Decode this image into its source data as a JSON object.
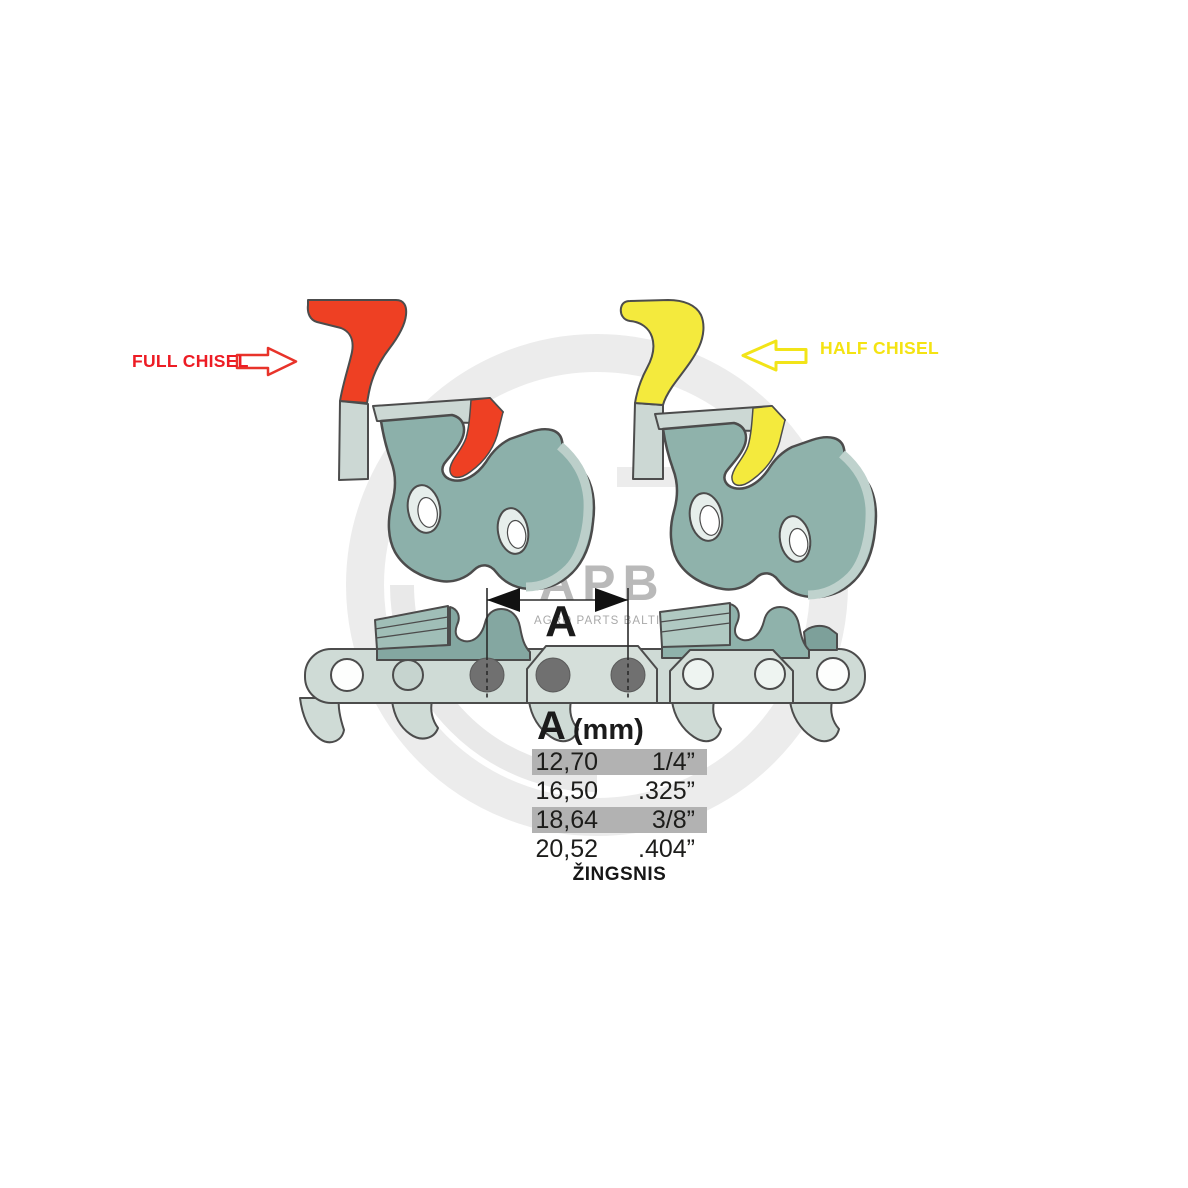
{
  "labels": {
    "full_chisel": "FULL CHISEL",
    "half_chisel": "HALF CHISEL",
    "dimension": "A",
    "pitch_caption": "ŽINGSNIS"
  },
  "watermark": {
    "logo": "APB",
    "tagline": "AGRO PARTS BALTIJA"
  },
  "pitch_table": {
    "header": {
      "symbol": "A",
      "unit": "(mm)"
    },
    "rows": [
      {
        "mm": "12,70",
        "inches": "1/4”",
        "highlighted": true
      },
      {
        "mm": "16,50",
        "inches": ".325”",
        "highlighted": false
      },
      {
        "mm": "18,64",
        "inches": "3/8”",
        "highlighted": true
      },
      {
        "mm": "20,52",
        "inches": ".404”",
        "highlighted": false
      }
    ]
  },
  "colors": {
    "full_chisel_accent": "#ee4023",
    "full_chisel_label": "#ed1c24",
    "half_chisel_accent": "#f4ea3d",
    "half_chisel_label": "#f4e312",
    "link_face": "#8cb0aa",
    "link_plate": "#ccd8d4",
    "chain_band": "#cfdbd6",
    "tie_strap": "#d5dfda",
    "cutter_dark": "#84a7a1",
    "cutter_light": "#8fb2ab",
    "rivet": "#707070",
    "outline": "#4c4c4c",
    "table_highlight": "#b2b2b2",
    "table_text": "#1d1d1b",
    "watermark_gray": "#b6b6b6"
  }
}
